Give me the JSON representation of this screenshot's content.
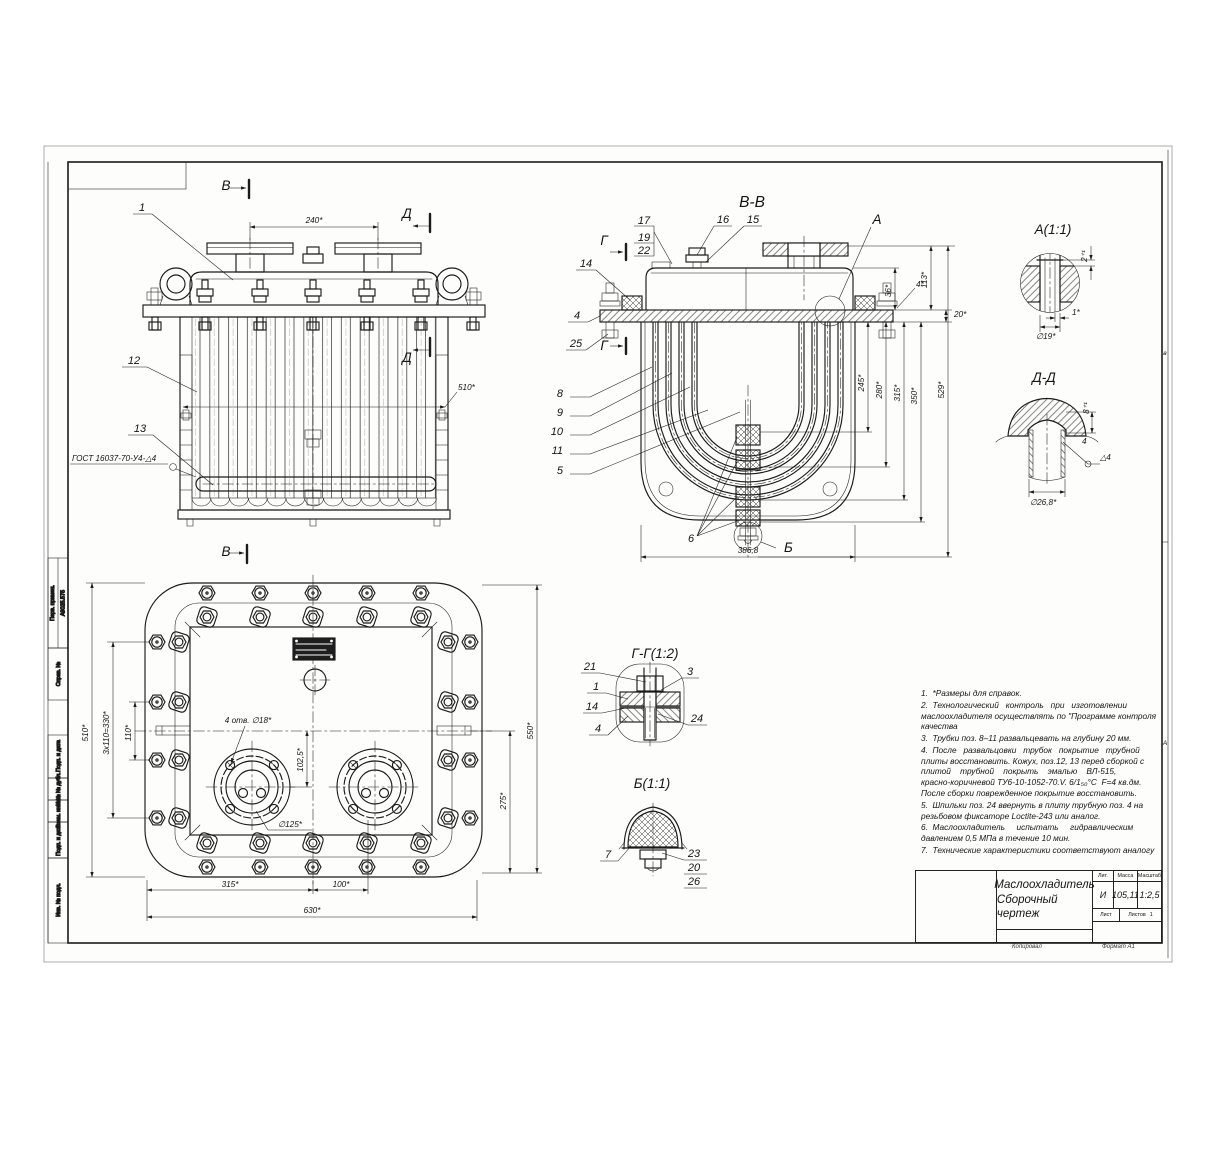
{
  "sheet": {
    "zone_letter_top": "в",
    "zone_letter_bottom": "А",
    "stamps": {
      "perv_primen": "Перв. примен.",
      "perv_value": "А9025.575",
      "sprav": "Справ. №",
      "podp1": "Подп. и дата",
      "inv_dubl": "Инв. № дубл.",
      "vzam": "Взам. инв. №",
      "podp2": "Подп. и дата",
      "inv_podl": "Инв. № подл."
    },
    "footer_left": "Копировал",
    "footer_right": "Формат А1"
  },
  "front": {
    "marker_b": "В",
    "marker_d": "Д",
    "dim_240": "240*",
    "dim_510": "510*",
    "pos_1": "1",
    "pos_12": "12",
    "pos_13": "13",
    "weld_note": "ГОСТ 16037-70-У4-△4"
  },
  "vv": {
    "title": "В-В",
    "pos_17": "17",
    "pos_19": "19",
    "pos_22": "22",
    "pos_16": "16",
    "pos_15": "15",
    "pos_14": "14",
    "pos_4": "4",
    "pos_25": "25",
    "pos_8": "8",
    "pos_9": "9",
    "pos_10": "10",
    "pos_11": "11",
    "pos_5": "5",
    "pos_6": "6",
    "marker_a": "А",
    "marker_b": "Б",
    "marker_g": "Г",
    "dim_36": "36*",
    "dim_113": "113*",
    "dim_4": "4*",
    "dim_20": "20*",
    "dim_245": "245*",
    "dim_280": "280*",
    "dim_315": "315*",
    "dim_350": "350*",
    "dim_529": "529*",
    "dim_3868": "386,8"
  },
  "detail_a": {
    "title": "А(1:1)",
    "dim_2": "2⁺¹",
    "dim_1": "1*",
    "dim_d19": "∅19*"
  },
  "detail_dd": {
    "title": "Д-Д",
    "dim_8": "8⁺¹",
    "dim_d268": "∅26,8*",
    "weld": "△4",
    "dim_4": "4"
  },
  "plan": {
    "marker_b": "В",
    "dim_510": "510*",
    "dim_330": "3x110=330*",
    "dim_110": "110*",
    "dim_550": "550*",
    "dim_275": "275*",
    "dim_315": "315*",
    "dim_100": "100*",
    "dim_630": "630*",
    "holes": "4 отв. ∅18*",
    "dim_1025": "102,5*",
    "dim_d125": "∅125*"
  },
  "gg": {
    "title": "Г-Г(1:2)",
    "pos_21": "21",
    "pos_1": "1",
    "pos_14": "14",
    "pos_4": "4",
    "pos_3": "3",
    "pos_24": "24"
  },
  "b11": {
    "title": "Б(1:1)",
    "pos_7": "7",
    "pos_23": "23",
    "pos_20": "20",
    "pos_26": "26"
  },
  "notes": {
    "n1": "1.  *Размеры для справок.",
    "n2": "2.  Технологический   контроль   при   изготовлении\nмаслоохладителя осуществлять по \"Программе контроля\nкачества",
    "n3": "3.  Трубки поз. 8–11 развальцевать на глубину 20 мм.",
    "n4": "4.  После   развальцовки   трубок   покрытие   трубной\nплиты восстановить. Кожух, поз.12, 13 перед сборкой с\nплитой    трубной    покрыть    эмалью    ВЛ-515,\nкрасно-коричневой ТУ6-10-1052-70.V. 6/1₅₀°С  F=4 кв.дм.\nПосле сборки поврежденное покрытие восстановить.",
    "n5": "5.  Шпильки поз. 24 ввернуть в плиту трубную поз. 4 на\nрезьбовом фиксаторе Loctite-243 или аналог.",
    "n6": "6.  Маслоохладитель     испытать     гидравлическим\nдавлением 0,5 МПа в течение 10 мин.",
    "n7": "7.  Технические характеристики соответствуют аналогу"
  },
  "title_block": {
    "name_line1": "Маслоохладитель",
    "name_line2": "Сборочный чертеж",
    "col_lit": "Лит.",
    "col_mass": "Масса",
    "col_scale": "Масштаб",
    "lit": "И",
    "mass": "105,11",
    "scale": "1:2,5",
    "sheet_label": "Лист",
    "sheets_label": "Листов",
    "sheets_value": "1"
  }
}
